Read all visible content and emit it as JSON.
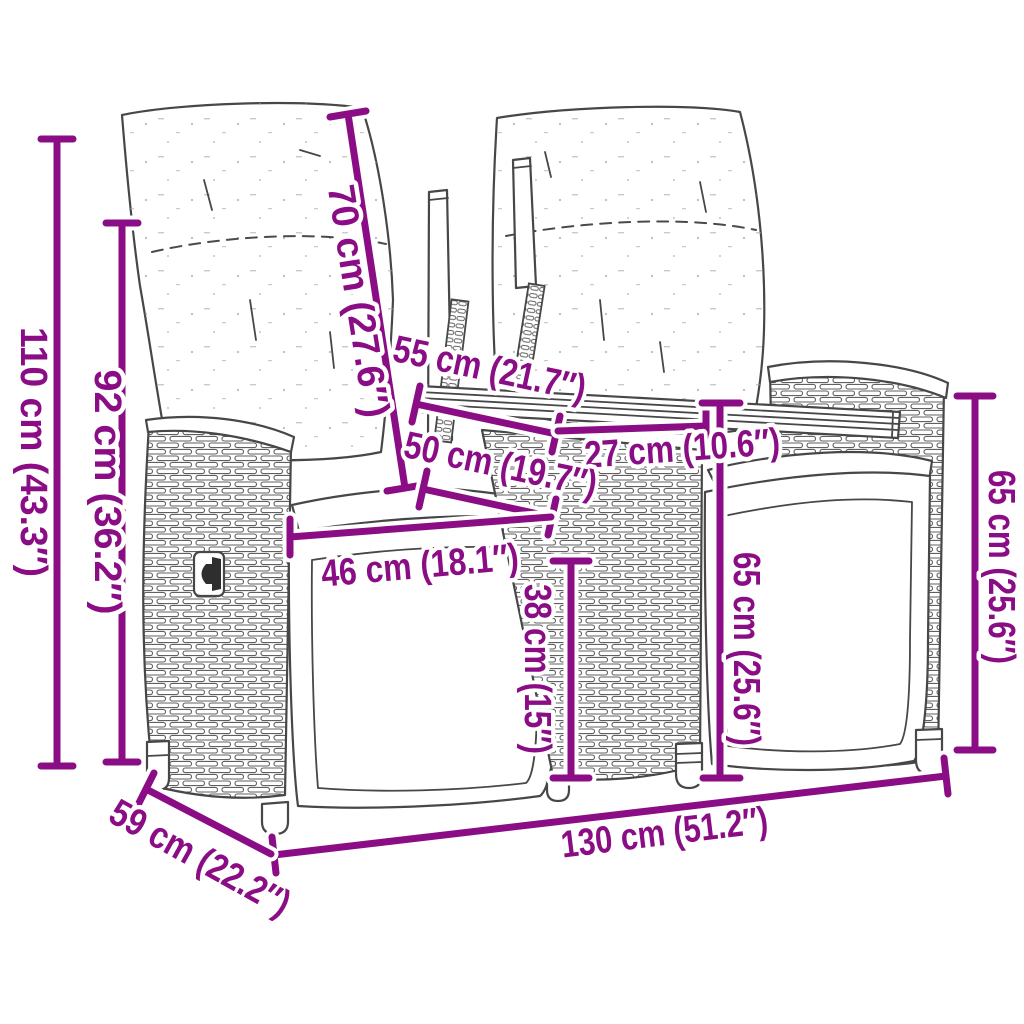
{
  "diagram": {
    "type": "furniture-dimension-drawing",
    "subject": "2-seater garden sofa with center table",
    "accent_color": "#8B0D85",
    "drawing_line_color": "#474747",
    "background_color": "#ffffff",
    "unit_system": "cm (inches)",
    "dimensions": [
      {
        "id": "total-height",
        "label": "110 cm (43.3″)"
      },
      {
        "id": "backrest-height",
        "label": "92 cm (36.2″)"
      },
      {
        "id": "backrest-length",
        "label": "70 cm (27.6″)"
      },
      {
        "id": "table-depth",
        "label": "55 cm (21.7″)"
      },
      {
        "id": "table-width",
        "label": "27 cm (10.6″)"
      },
      {
        "id": "seat-depth",
        "label": "50 cm (19.7″)"
      },
      {
        "id": "seat-width",
        "label": "46 cm (18.1″)"
      },
      {
        "id": "seat-front-height",
        "label": "38 cm (15″)"
      },
      {
        "id": "side-height-inner",
        "label": "65 cm (25.6″)"
      },
      {
        "id": "side-height-outer",
        "label": "65 cm (25.6″)"
      },
      {
        "id": "total-width",
        "label": "130 cm (51.2″)"
      },
      {
        "id": "total-depth",
        "label": "59 cm (22.2″)"
      }
    ]
  }
}
